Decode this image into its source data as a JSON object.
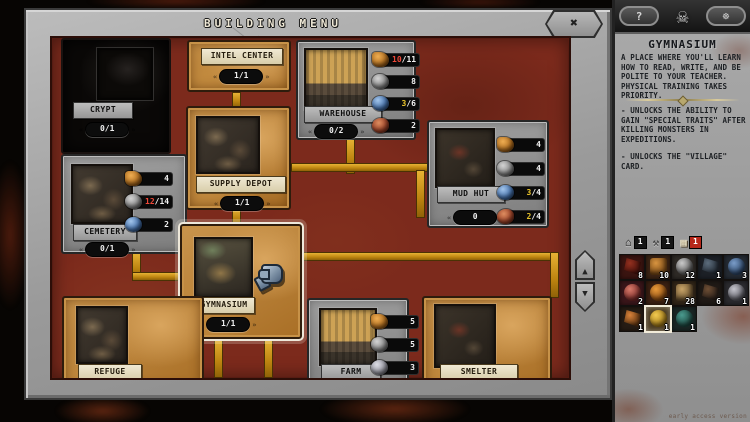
{
  "title_bar": {
    "title": "BUILDING MENU",
    "close_icon": "✖"
  },
  "board": {
    "cards": [
      {
        "id": "crypt",
        "label": "CRYPT",
        "counter": "0/1",
        "style": "locked",
        "resources": []
      },
      {
        "id": "intel-center",
        "label": "INTEL CENTER",
        "counter": "1/1",
        "style": "tan",
        "resources": []
      },
      {
        "id": "warehouse",
        "label": "WAREHOUSE",
        "counter": "0/2",
        "style": "gray",
        "resources": [
          {
            "icon": "wood",
            "cur": "10",
            "max": "11",
            "color": "red"
          },
          {
            "icon": "stone",
            "cur": "8",
            "max": "",
            "color": "white"
          },
          {
            "icon": "soul",
            "cur": "3",
            "max": "6",
            "color": "yellow"
          },
          {
            "icon": "meat",
            "cur": "2",
            "max": "",
            "color": "white"
          }
        ]
      },
      {
        "id": "supply-depot",
        "label": "SUPPLY DEPOT",
        "counter": "1/1",
        "style": "tan",
        "resources": []
      },
      {
        "id": "cemetery",
        "label": "CEMETERY",
        "counter": "0/1",
        "style": "gray",
        "resources": [
          {
            "icon": "wood",
            "cur": "4",
            "max": "",
            "color": "white"
          },
          {
            "icon": "stone",
            "cur": "12",
            "max": "14",
            "color": "red"
          },
          {
            "icon": "soul",
            "cur": "2",
            "max": "",
            "color": "white"
          }
        ]
      },
      {
        "id": "mud-hut",
        "label": "MUD HUT",
        "counter": "0",
        "style": "gray",
        "resources": [
          {
            "icon": "wood",
            "cur": "4",
            "max": "",
            "color": "white"
          },
          {
            "icon": "stone",
            "cur": "4",
            "max": "",
            "color": "white"
          },
          {
            "icon": "soul",
            "cur": "3",
            "max": "4",
            "color": "yellow"
          },
          {
            "icon": "meat",
            "cur": "2",
            "max": "4",
            "color": "yellow"
          }
        ]
      },
      {
        "id": "gymnasium",
        "label": "GYMNASIUM",
        "counter": "1/1",
        "style": "tan",
        "selected": true,
        "resources": []
      },
      {
        "id": "refuge",
        "label": "REFUGE",
        "counter": null,
        "style": "tan",
        "resources": []
      },
      {
        "id": "farm",
        "label": "FARM",
        "counter": null,
        "style": "gray",
        "resources": [
          {
            "icon": "wood",
            "cur": "5",
            "max": "",
            "color": "white"
          },
          {
            "icon": "stone",
            "cur": "5",
            "max": "",
            "color": "white"
          },
          {
            "icon": "silver",
            "cur": "3",
            "max": "",
            "color": "white"
          }
        ]
      },
      {
        "id": "smelter",
        "label": "SMELTER",
        "counter": null,
        "style": "tan",
        "resources": []
      }
    ],
    "scroll": {
      "up_icon": "▲",
      "down_icon": "▼"
    }
  },
  "sidebar": {
    "header": {
      "help_label": "?",
      "skull_icon": "☠",
      "settings_icon": "☸"
    },
    "building": {
      "title": "GYMNASIUM",
      "description": "A PLACE WHERE YOU'LL LEARN\nHOW TO READ, WRITE, AND BE\nPOLITE TO YOUR TEACHER.\nPHYSICAL TRAINING TAKES\nPRIORITY.",
      "effects": [
        "- UNLOCKS THE ABILITY TO\nGAIN \"SPECIAL TRAITS\" AFTER\nKILLING MONSTERS IN\nEXPEDITIONS.",
        "- UNLOCKS THE \"VILLAGE\"\nCARD."
      ]
    },
    "tabs": [
      {
        "id": "buildings",
        "icon": "⌂",
        "count": "1",
        "selected": false
      },
      {
        "id": "tools",
        "icon": "⚒",
        "count": "1",
        "selected": false
      },
      {
        "id": "cards",
        "icon": "▦",
        "count": "1",
        "selected": true
      }
    ],
    "inventory": [
      {
        "item": "scythe",
        "count": "8",
        "bg": "#3a1410",
        "hi": "#93301f",
        "lo": "#47110b",
        "shape": "blade"
      },
      {
        "item": "planks",
        "count": "10",
        "bg": "#3c2414",
        "hi": "#d89440",
        "lo": "#7a4a16",
        "shape": "box"
      },
      {
        "item": "stone",
        "count": "12",
        "bg": "#2e2a26",
        "hi": "#c9c9c9",
        "lo": "#5d5d5d",
        "shape": "orb"
      },
      {
        "item": "hook",
        "count": "1",
        "bg": "#1c2026",
        "hi": "#5c6c7c",
        "lo": "#252d37",
        "shape": "blade"
      },
      {
        "item": "soul-orb",
        "count": "3",
        "bg": "#242a32",
        "hi": "#7a9cc8",
        "lo": "#2c4668",
        "shape": "orb"
      },
      {
        "item": "meat",
        "count": "2",
        "bg": "#3a161a",
        "hi": "#d87a6a",
        "lo": "#7a2a28",
        "shape": "orb"
      },
      {
        "item": "amber-orb",
        "count": "7",
        "bg": "#3a2012",
        "hi": "#e89a3a",
        "lo": "#8a4a12",
        "shape": "orb"
      },
      {
        "item": "crate",
        "count": "28",
        "bg": "#322618",
        "hi": "#c8a468",
        "lo": "#6a5230",
        "shape": "box"
      },
      {
        "item": "horn",
        "count": "6",
        "bg": "#201a16",
        "hi": "#6e4e34",
        "lo": "#291f19",
        "shape": "blade"
      },
      {
        "item": "silver-orb",
        "count": "1",
        "bg": "#2a2a2e",
        "hi": "#c4c4cc",
        "lo": "#5a5a62",
        "shape": "orb"
      },
      {
        "item": "hatchet",
        "count": "1",
        "bg": "#261c14",
        "hi": "#d8823a",
        "lo": "#5a3210",
        "shape": "blade"
      },
      {
        "item": "golden-egg",
        "count": "1",
        "bg": "#4a3a1e",
        "hi": "#f2ca50",
        "lo": "#a07818",
        "shape": "orb",
        "selected": true
      },
      {
        "item": "teal-shell",
        "count": "1",
        "bg": "#1a2624",
        "hi": "#4a9a8e",
        "lo": "#1e4a42",
        "shape": "orb"
      }
    ],
    "watermark": "early access version"
  }
}
